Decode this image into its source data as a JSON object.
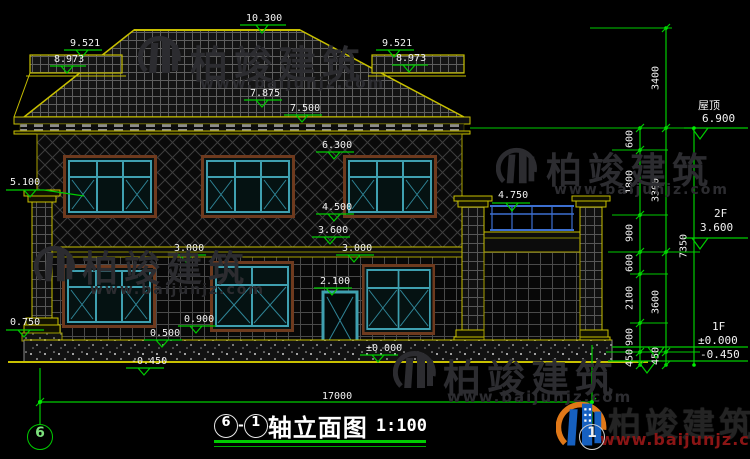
{
  "title": {
    "name": "轴立面图",
    "scale": "1:100",
    "dash": "-"
  },
  "axes": {
    "left": "6",
    "right": "1"
  },
  "dims": {
    "inner": [
      "600",
      "1800",
      "900",
      "600",
      "2100",
      "900",
      "450"
    ],
    "outer": [
      "3400",
      "3300",
      "3600",
      "450"
    ],
    "total_height": "7350",
    "total_width": "17000"
  },
  "levels": {
    "roof": {
      "label": "屋顶",
      "value": "6.900"
    },
    "f2": {
      "label": "2F",
      "value": "3.600"
    },
    "f1": {
      "label": "1F",
      "value": "±0.000"
    },
    "below": {
      "value": "-0.450"
    }
  },
  "ann": {
    "ridge": "10.300",
    "wing_top_l": "9.521",
    "wing_eave_l": "8.973",
    "wing_top_r": "9.521",
    "wing_eave_r": "8.973",
    "eave_upper": "7.875",
    "eave_lower": "7.500",
    "win2f_head": "6.300",
    "porch_cap": "5.100",
    "rail_top": "4.750",
    "win2f_sill": "4.500",
    "floor2": "3.600",
    "win1f_head_l": "3.000",
    "win1f_head_r": "3.000",
    "door_head": "2.100",
    "win1f_sill": "0.900",
    "sill_low": "0.500",
    "pedestal": "0.750",
    "zero": "±0.000",
    "minus": "-0.450"
  },
  "watermark": {
    "brand": "柏竣建筑",
    "url": "www.baijunjz.com"
  },
  "colors": {
    "annotation_green": "#00cc00",
    "line_yellow": "#c8c000",
    "window_teal": "#3fa0b0",
    "frame_brown": "#6e3a1e",
    "railing_blue": "#3c6fd0",
    "logo_blue": "#1660c0",
    "logo_orange": "#e07818",
    "url_red": "#8a1515"
  }
}
